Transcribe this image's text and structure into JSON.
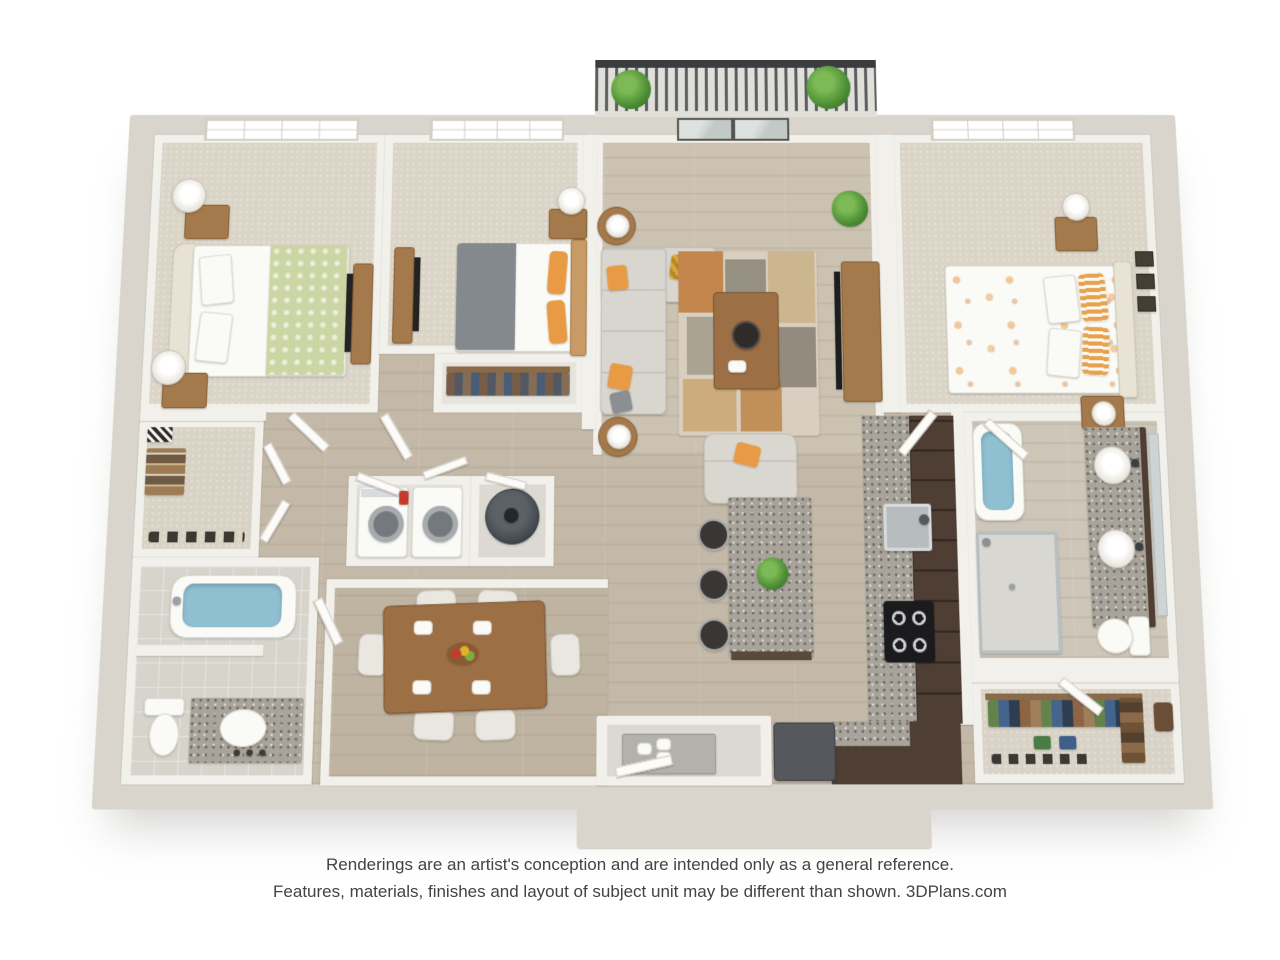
{
  "page": {
    "background": "#ffffff",
    "type": "3D floor plan rendering",
    "view": "top-down perspective"
  },
  "footer": {
    "line1": "Renderings are an artist's conception and are intended only as a general reference.",
    "line2": "Features, materials, finishes and layout of subject unit may be different than shown.",
    "brand": "3DPlans.com"
  },
  "plan": {
    "bedrooms": 3,
    "bathrooms": 2,
    "rooms": [
      "bedroom-1",
      "bedroom-2",
      "master-bedroom",
      "living-room",
      "balcony",
      "hallway",
      "walk-in-closet",
      "hall-bathroom",
      "laundry-closet",
      "utility-closet",
      "dining-room",
      "kitchen",
      "entry",
      "master-bathroom",
      "master-closet",
      "bedroom-2-closet"
    ],
    "features": {
      "balcony": [
        "railing",
        "potted-plant",
        "potted-plant"
      ],
      "living-room": [
        "sectional-sofa",
        "area-rug",
        "coffee-table",
        "armchair",
        "tv-console",
        "tall-plant",
        "side-tables",
        "french-doors"
      ],
      "kitchen": [
        "granite-island",
        "bar-stools",
        "sink",
        "cooktop",
        "refrigerator",
        "espresso-cabinets"
      ],
      "dining-room": [
        "table-for-six",
        "fruit-bowl"
      ],
      "laundry-closet": [
        "washer",
        "dryer"
      ],
      "utility-closet": [
        "water-heater"
      ],
      "hall-bathroom": [
        "bathtub",
        "toilet",
        "vanity-sink"
      ],
      "master-bathroom": [
        "garden-tub",
        "walk-in-shower",
        "double-vanity",
        "toilet"
      ],
      "master-closet": [
        "hanging-clothes",
        "shoes"
      ],
      "bedrooms": [
        "beds",
        "nightstands",
        "lamps",
        "tv-dressers",
        "windows"
      ]
    }
  },
  "palette": {
    "background": "#ffffff",
    "exterior_wall": "#d9d5cd",
    "interior_wall": "#f2f0ea",
    "wood_floor": "#c4b9a8",
    "carpet": "#dbd5c8",
    "granite": "#a8a49b",
    "espresso_cabinet": "#4e3e33",
    "wood_furniture": "#a4794b",
    "water_blue": "#8fc0d2",
    "sofa_gray": "#d9d6cf",
    "accent_orange": "#e89a45",
    "duvet_green": "#ccd6a4",
    "duvet_gray": "#84898d",
    "railing_dark": "#3a3d40",
    "plant_green": "#4c8f35",
    "appliance_dark": "#55585c",
    "text_gray": "#434343"
  }
}
